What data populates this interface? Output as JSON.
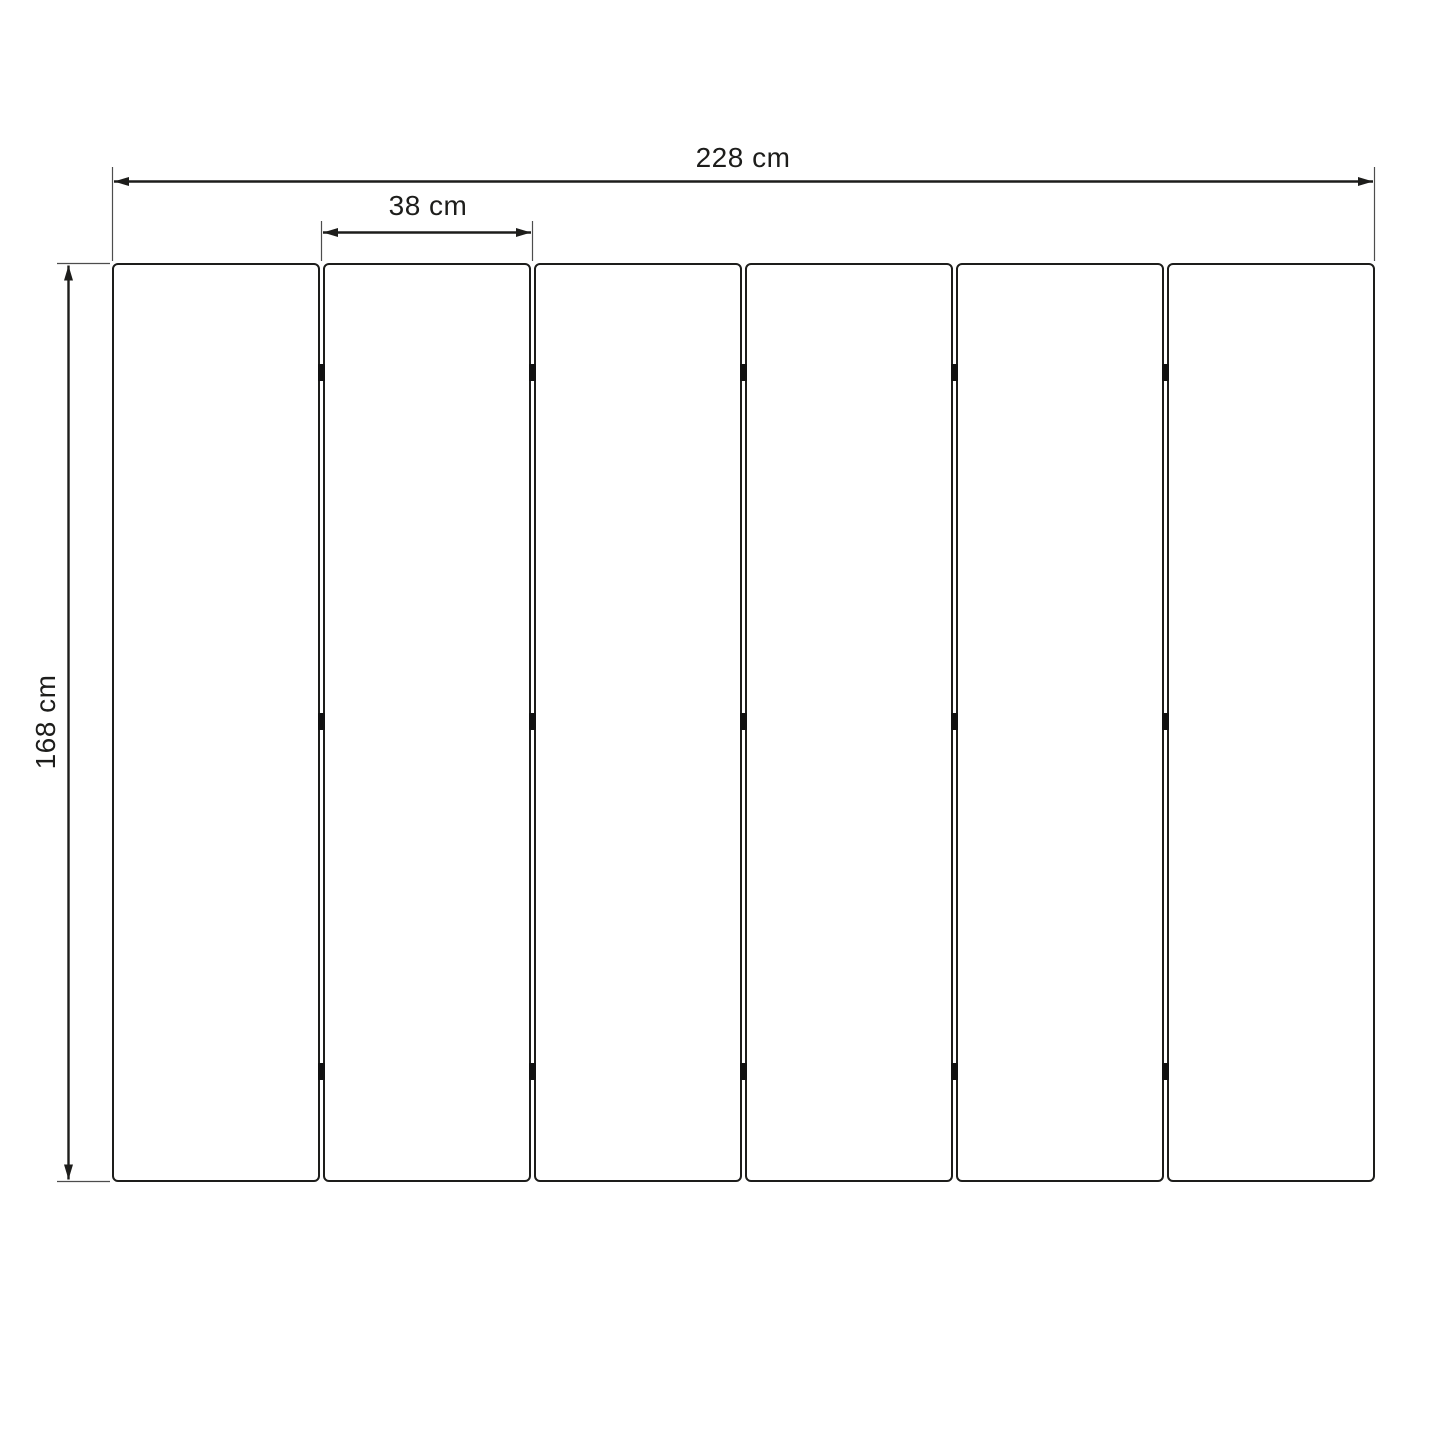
{
  "diagram": {
    "kind": "technical-dimension-drawing",
    "subject": "six-panel folding screen front view",
    "panel_count": 6,
    "joint_count": 5,
    "hinges_per_joint": 3,
    "dimensions": {
      "total_width": "228 cm",
      "panel_width": "38 cm",
      "height": "168 cm"
    },
    "colors": {
      "line": "#1d1d1b",
      "extension_line": "#4d4d4d",
      "hinge": "#111111",
      "background": "#ffffff"
    }
  }
}
